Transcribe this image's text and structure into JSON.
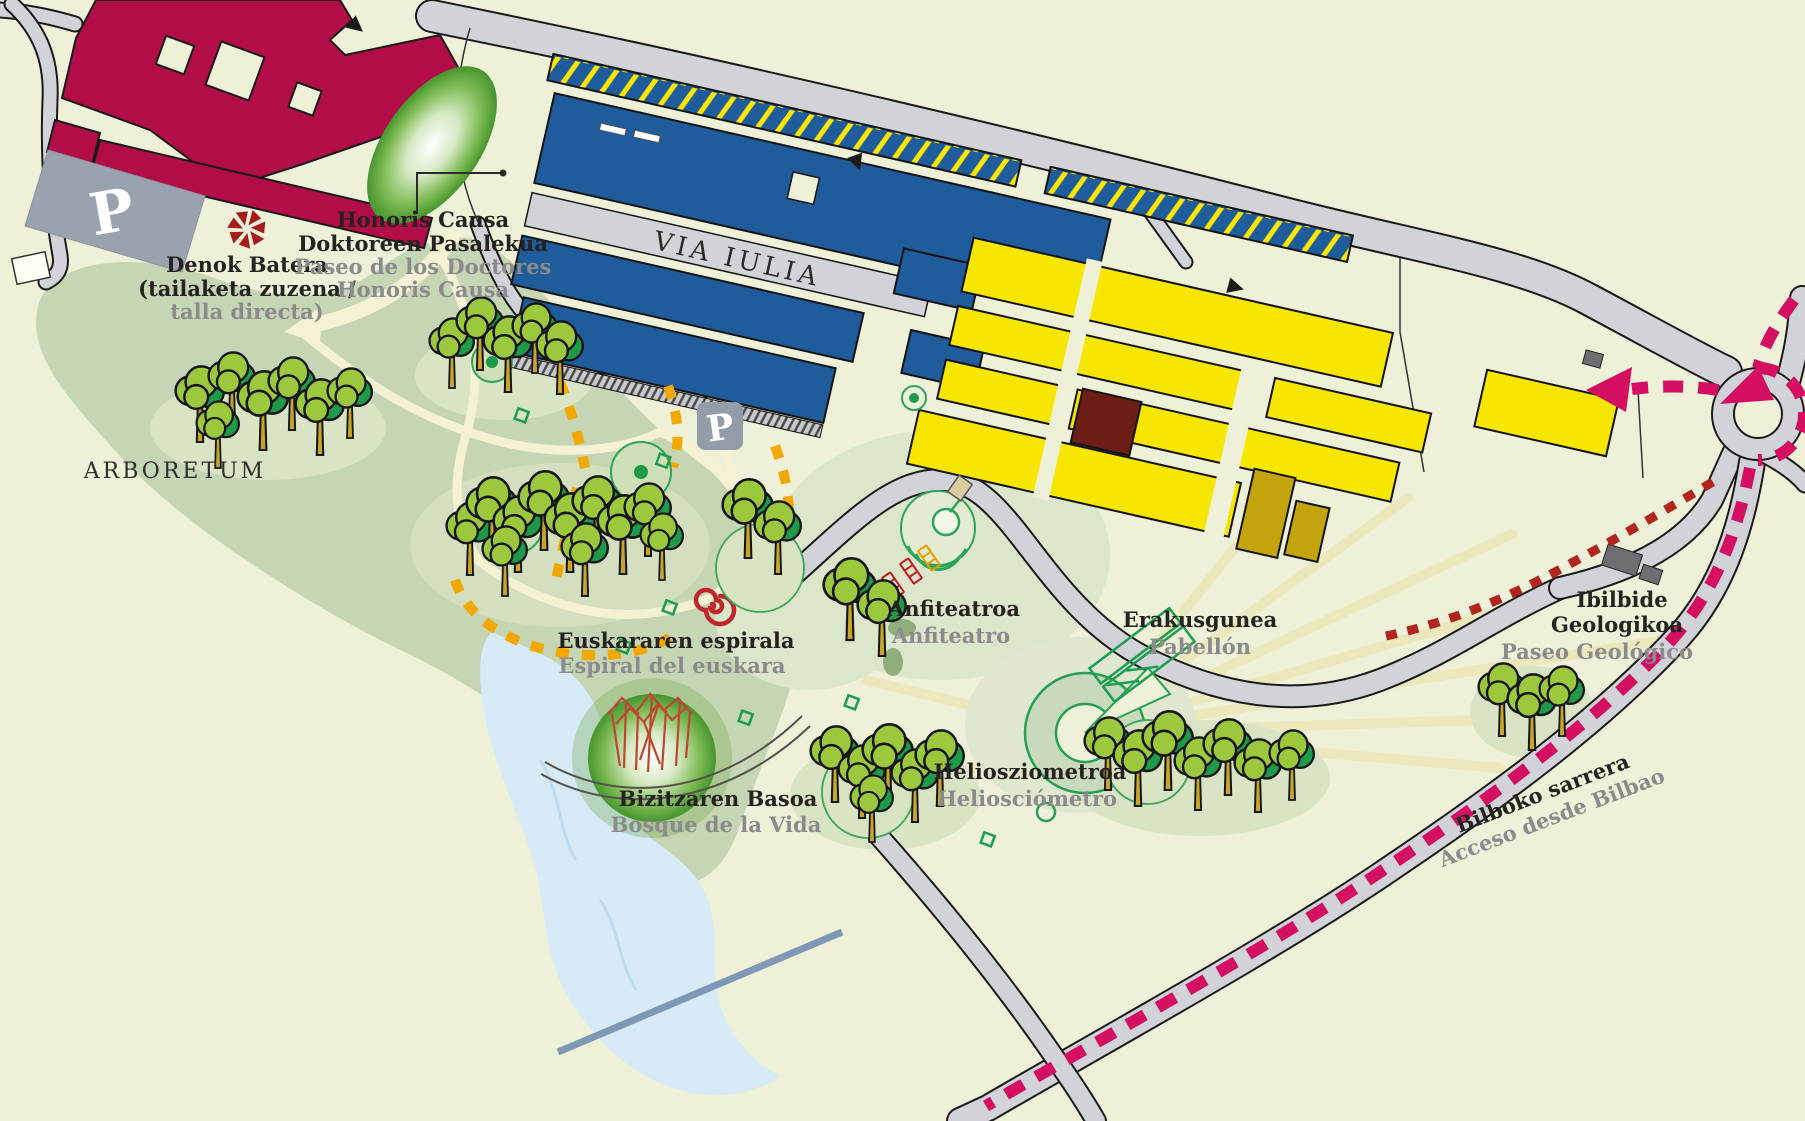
{
  "map": {
    "region_label": "ARBORETUM",
    "street_label": "VIA IULIA",
    "parking_symbol": "P",
    "pois": {
      "denok_batera": {
        "line1": "Denok Batera",
        "line2": "(tailaketa zuzena /",
        "line3_es": "talla directa)"
      },
      "honoris_causa": {
        "line1": "Honoris Causa",
        "line2": "Doktoreen Pasalekua",
        "line3_es": "Paseo de los Doctores",
        "line4_es": "Honoris Causa"
      },
      "euskararen_espirala": {
        "eu": "Euskararen espirala",
        "es": "Espiral del euskara"
      },
      "bizitzaren_basoa": {
        "eu": "Bizitzaren Basoa",
        "es": "Bosque de la Vida"
      },
      "anfiteatroa": {
        "eu": "Anfiteatroa",
        "es": "Anfiteatro"
      },
      "erakusgunea": {
        "eu": "Erakusgunea",
        "es": "Pabellón"
      },
      "heliosziometroa": {
        "eu": "Heliosziometroa",
        "es": "Heliosciómetro"
      },
      "ibilbide_geologikoa": {
        "eu_line1": "Ibilbide",
        "eu_line2": "Geologikoa",
        "es": "Paseo Geológico"
      },
      "bilboko_sarrera": {
        "eu": "Bilboko sarrera",
        "es": "Acceso desde Bilbao"
      }
    },
    "icons": {
      "parking": "P badge",
      "denok_batera_sculpture": "red pinwheel",
      "euskara_spiral": "red spiral",
      "amphitheatre": "green ring seats",
      "heliosciometer": "green ring dial",
      "pavilion": "green slanted frames",
      "life_forest_sculpture": "red pole canopy",
      "roundabout": "circle junction",
      "route_arrow": "pink triangle",
      "direction_arrow": "black triangle",
      "tree": "stylized pine"
    },
    "routes": {
      "bilbao_access_color": "#d40f62",
      "arboretum_trail_color": "#f2a800",
      "geologic_walk_color": "#b2251f"
    },
    "colors": {
      "background": "#eef0d8",
      "arboretum_green": "#c6d5b3",
      "water": "#d6eaf7",
      "road": "#d2d3d8",
      "building_crimson": "#b30d49",
      "building_blue": "#1e5c9b",
      "building_yellow": "#f7e600",
      "building_maroon": "#6d1f15",
      "building_olive": "#c3a40c",
      "icon_green": "#2aa55a",
      "text_dark": "#26221f",
      "text_gray": "#8b8b8e"
    }
  }
}
